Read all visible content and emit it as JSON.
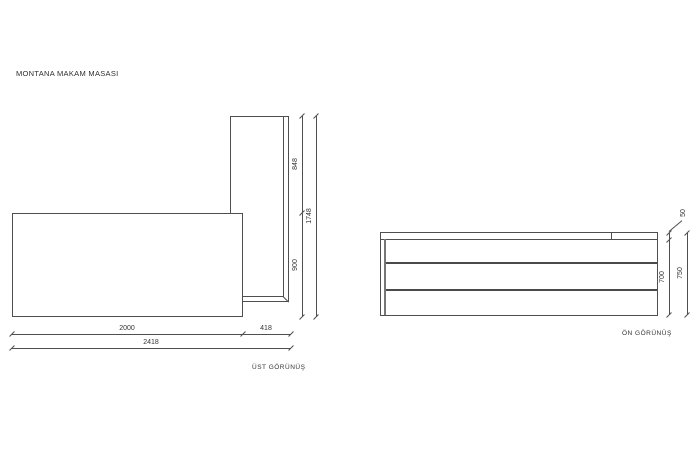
{
  "title": "MONTANA MAKAM MASASI",
  "colors": {
    "line": "#4f4f4f",
    "divider": "#4a4a4a",
    "text": "#333333",
    "background": "#ffffff"
  },
  "top_view": {
    "caption": "ÜST GÖRÜNÜŞ",
    "dims": {
      "desk_width": "2000",
      "return_width": "418",
      "total_width": "2418",
      "return_depth": "848",
      "desk_depth": "900",
      "total_depth": "1748"
    }
  },
  "front_view": {
    "caption": "ÖN GÖRÜNÜŞ",
    "dims": {
      "top_thickness": "50",
      "body_height": "700",
      "total_height": "750"
    }
  }
}
